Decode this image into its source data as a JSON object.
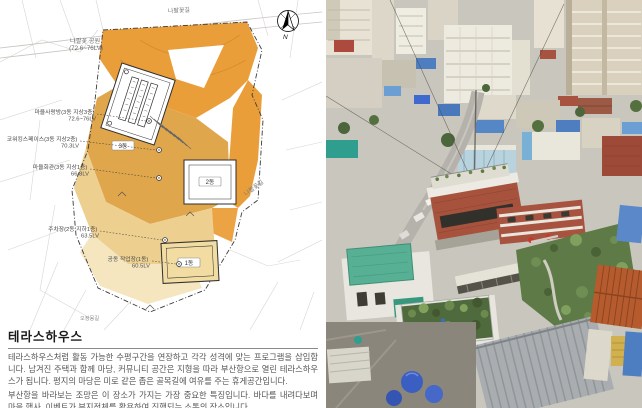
{
  "plan": {
    "roads": {
      "top": "나팔꽃길",
      "right": "나팔꽃길",
      "bottom": "오정몽길"
    },
    "park": {
      "name": "나팔꽃 공원",
      "level": "(72.6~76LV)"
    },
    "annotations": [
      {
        "text": "마을사랑방(3동 지상3층)",
        "level": "72.6~76LV"
      },
      {
        "text": "코워킹스페이스(3동 지상2층)",
        "level": "70.3LV"
      },
      {
        "text": "마을회관(3동 지상1층)",
        "level": "66.8LV"
      },
      {
        "text": "주차장(2동 지하1층)",
        "level": "63.5LV"
      },
      {
        "text": "공동 작업장(1동)",
        "level": "60.5LV"
      }
    ],
    "badges": [
      "3동",
      "2동",
      "1동"
    ],
    "compass_label": "N",
    "colors": {
      "orange": "#EA9E3A",
      "gold": "#DFA64C",
      "cream": "#EDCF90",
      "pale": "#F5E6C0"
    }
  },
  "description": {
    "title": "테라스하우스",
    "paragraphs": [
      "테라스하우스처럼 활동 가능한 수평구간을 연장하고 각각 성격에 맞는 프로그램을 삽입합니다. 남겨진 주택과 함께 마당, 커뮤니티 공간은 지형을 따라 부산항으로 열린 테라스하우스가 됩니다. 평지의 마당은 미로 같은 좁은 골목길에 여유를 주는 휴게공간입니다.",
      "부산항을 바라보는 조망은 이 장소가 가지는 가장 중요한 특징입니다. 바다를 내려다보며 마을 행사, 이벤트가 부지전체를 활용하여 진행되는 소통의 장소입니다."
    ]
  },
  "photo": {
    "colors": {
      "brick": "#a7523d",
      "mint_roof": "#57b093",
      "blue_roof": "#4f7ec0",
      "vegetation": "#5d7a47",
      "tile_roof": "#b55b2e"
    }
  }
}
